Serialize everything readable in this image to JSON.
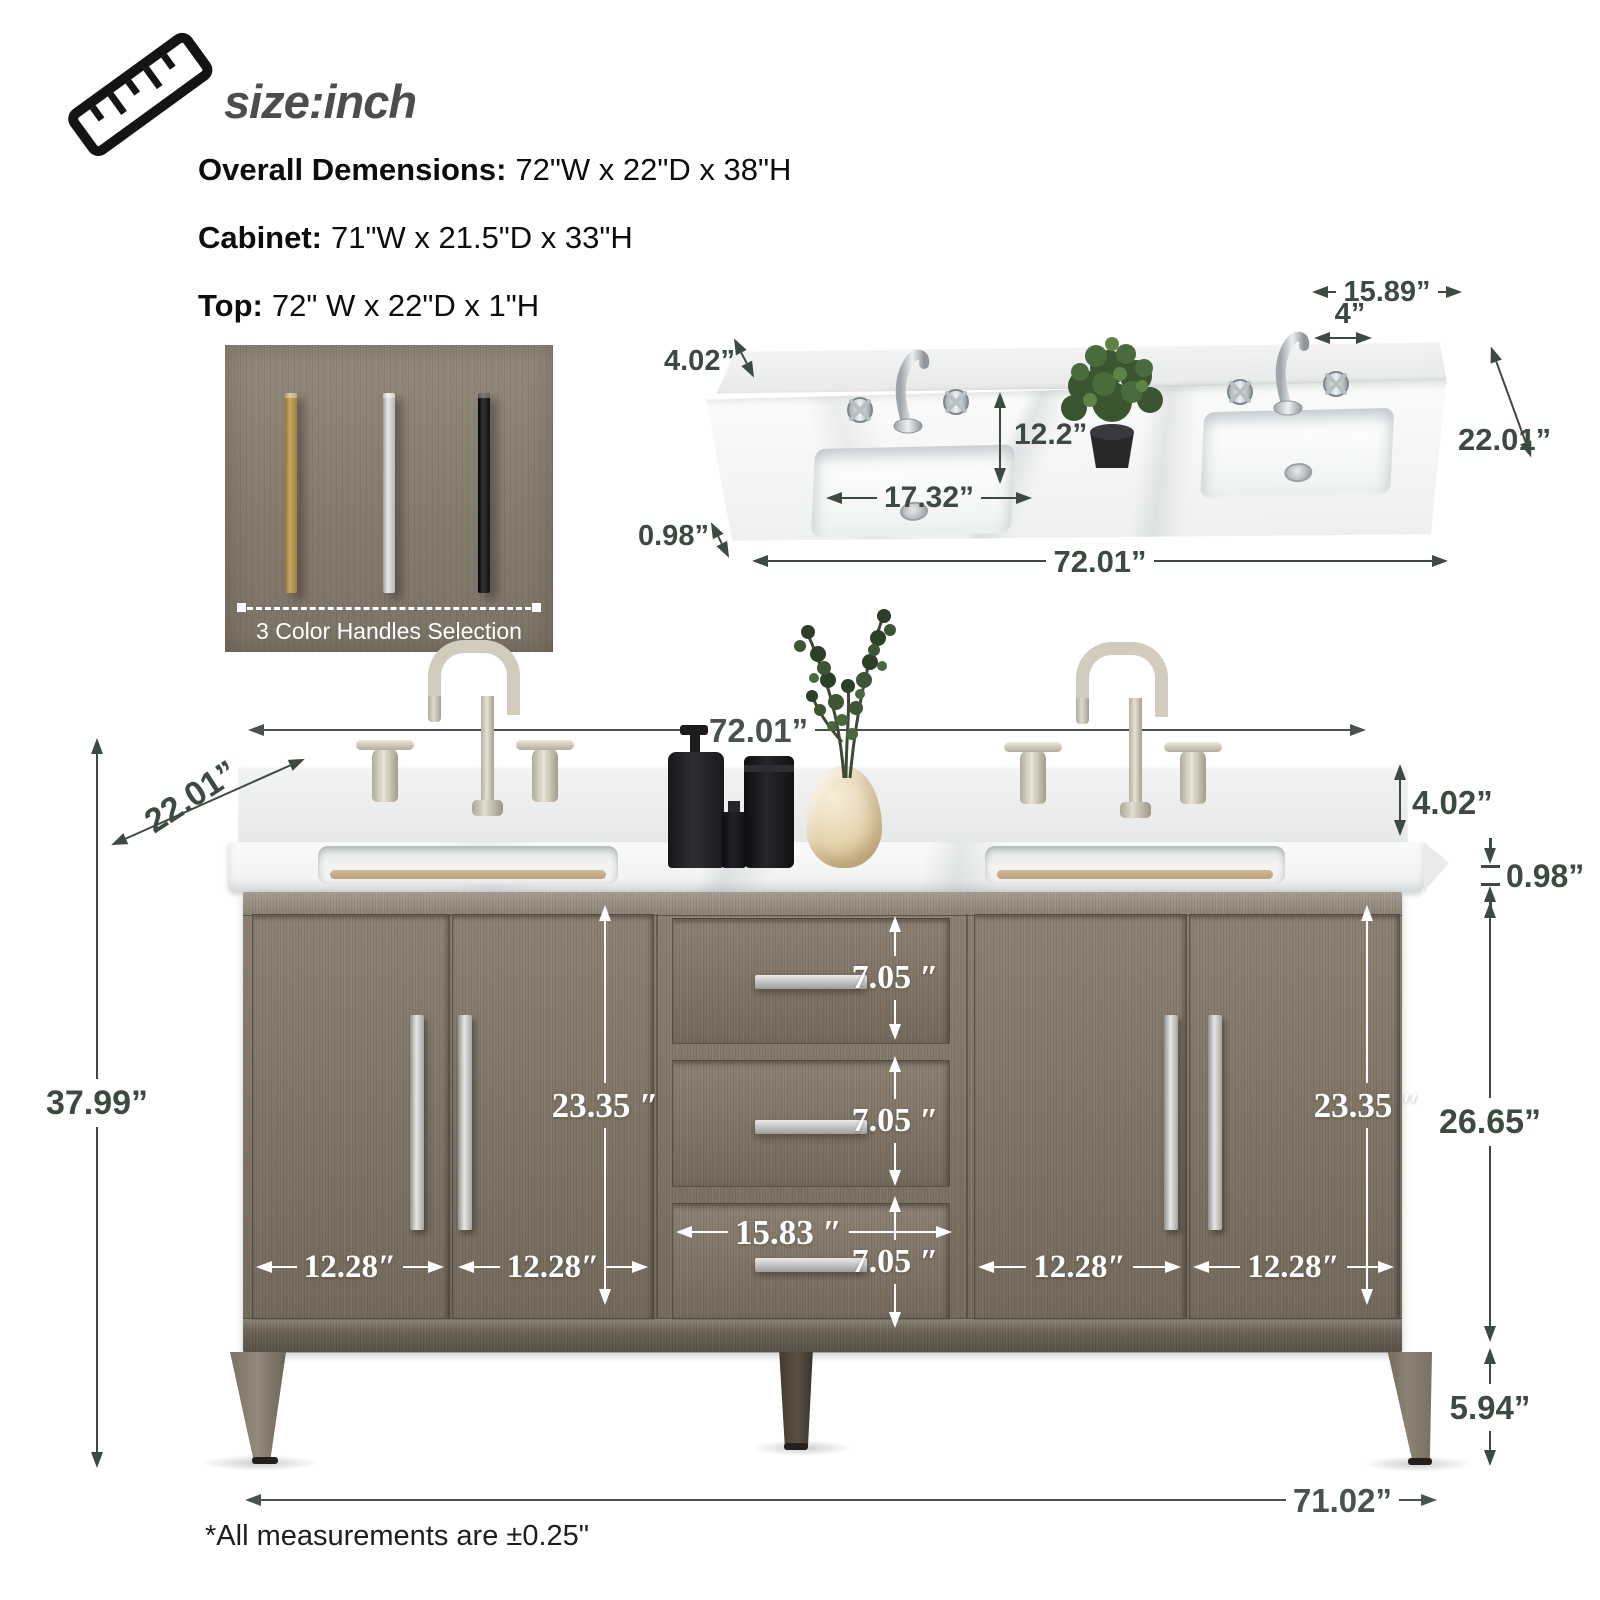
{
  "header": {
    "title": "size:inch",
    "specs": [
      {
        "label": "Overall Demensions:",
        "value": "72\"W x 22\"D x 38\"H"
      },
      {
        "label": "Cabinet:",
        "value": "71\"W x 21.5\"D x 33\"H"
      },
      {
        "label": "Top:",
        "value": "72\" W x 22\"D x 1\"H"
      }
    ]
  },
  "handle_box": {
    "caption": "3 Color Handles Selection",
    "handles": [
      {
        "name": "gold",
        "color": "#ad8c4e"
      },
      {
        "name": "silver",
        "color": "#cccccc"
      },
      {
        "name": "black",
        "color": "#1b1b1b"
      }
    ]
  },
  "top_view": {
    "dims": {
      "faucet_span": "15.89”",
      "faucet_hole_spacing": "4”",
      "backsplash_height": "4.02”",
      "depth": "22.01”",
      "sink_depth": "12.2”",
      "sink_width": "17.32”",
      "top_thickness": "0.98”",
      "total_width": "72.01”"
    }
  },
  "front_view": {
    "dims": {
      "total_width": "72.01”",
      "depth": "22.01”",
      "backsplash_height": "4.02”",
      "top_thickness": "0.98”",
      "total_height": "37.99”",
      "left_door_height": "23.35 ″",
      "right_door_height": "23.35 ″",
      "drawer1_height": "7.05 ″",
      "drawer2_height": "7.05 ″",
      "drawer3_height": "7.05 ″",
      "drawer_width": "15.83 ″",
      "door1_width": "12.28″",
      "door2_width": "12.28″",
      "door3_width": "12.28″",
      "door4_width": "12.28″",
      "cabinet_height": "26.65”",
      "leg_height": "5.94”",
      "base_width": "71.02”"
    }
  },
  "footnote": "*All measurements are ±0.25\"",
  "colors": {
    "dimension_dark": "#3d4a41",
    "dimension_light": "#ffffff",
    "wood": "#857a6c"
  }
}
